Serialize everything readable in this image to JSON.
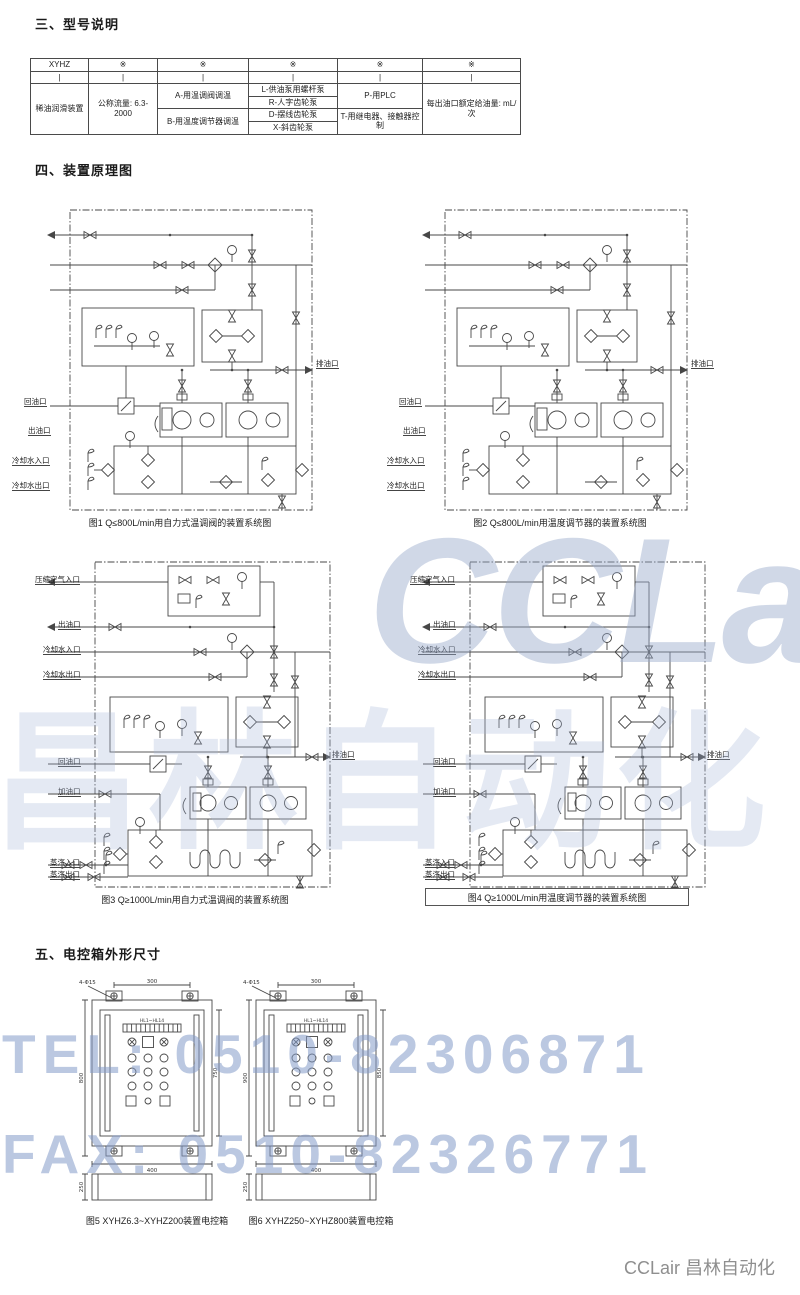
{
  "sections": {
    "model_title": "三、型号说明",
    "schematic_title": "四、装置原理图",
    "cabinet_title": "五、电控箱外形尺寸"
  },
  "footer_brand": "CCLair 昌林自动化",
  "watermarks": {
    "logo": "CCLair",
    "cn": "昌林自动化",
    "tel": "TEL: 0510-82306871",
    "fax": "FAX: 0510-82326771",
    "color": "#9eb2d8"
  },
  "model_table": {
    "header": [
      "XYHZ",
      "※",
      "※",
      "※",
      "※",
      "※"
    ],
    "pipes": [
      "|",
      "|",
      "|",
      "|",
      "|",
      "|"
    ],
    "col1": "稀油润滑装置",
    "col2": "公称流量: 6.3-2000",
    "col3a": "A-用温调阀调温",
    "col3b": "B-用温度调节器调温",
    "col4": [
      "L-供油泵用螺杆泵",
      "R-人字齿轮泵",
      "D-摆线齿轮泵",
      "X-斜齿轮泵"
    ],
    "col5a": "P-用PLC",
    "col5b": "T-用继电器、接触器控制",
    "col6": "每出油口额定给油量: mL/次"
  },
  "diagrams": [
    {
      "caption": "图1 Q≤800L/min用自力式温调阀的装置系统图",
      "ports_left": [
        "出油口",
        "冷却水入口",
        "冷却水出口",
        "回油口"
      ],
      "port_right": "排油口"
    },
    {
      "caption": "图2 Q≤800L/min用温度调节器的装置系统图",
      "ports_left": [
        "出油口",
        "冷却水入口",
        "冷却水出口",
        "回油口"
      ],
      "port_right": "排油口"
    },
    {
      "caption": "图3 Q≥1000L/min用自力式温调阀的装置系统图",
      "ports_left": [
        "压缩空气入口",
        "出油口",
        "冷却水入口",
        "冷却水出口",
        "回油口",
        "加油口",
        "蒸汽入口",
        "蒸汽出口"
      ],
      "port_right": "排油口"
    },
    {
      "caption": "图4 Q≥1000L/min用温度调节器的装置系统图",
      "ports_left": [
        "压缩空气入口",
        "出油口",
        "冷却水入口",
        "冷却水出口",
        "回油口",
        "加油口",
        "蒸汽入口",
        "蒸汽出口"
      ],
      "port_right": "排油口"
    }
  ],
  "control_boxes": [
    {
      "caption": "图5 XYHZ6.3~XYHZ200装置电控箱",
      "holes": "4-Φ15",
      "panel": "HL1~HL14",
      "dims": {
        "top": "300",
        "bottom": "400",
        "left": "800",
        "right": "750",
        "side": "250"
      }
    },
    {
      "caption": "图6 XYHZ250~XYHZ800装置电控箱",
      "holes": "4-Φ15",
      "panel": "HL1~HL14",
      "dims": {
        "top": "300",
        "bottom": "400",
        "left": "900",
        "right": "850",
        "side": "250"
      }
    }
  ]
}
